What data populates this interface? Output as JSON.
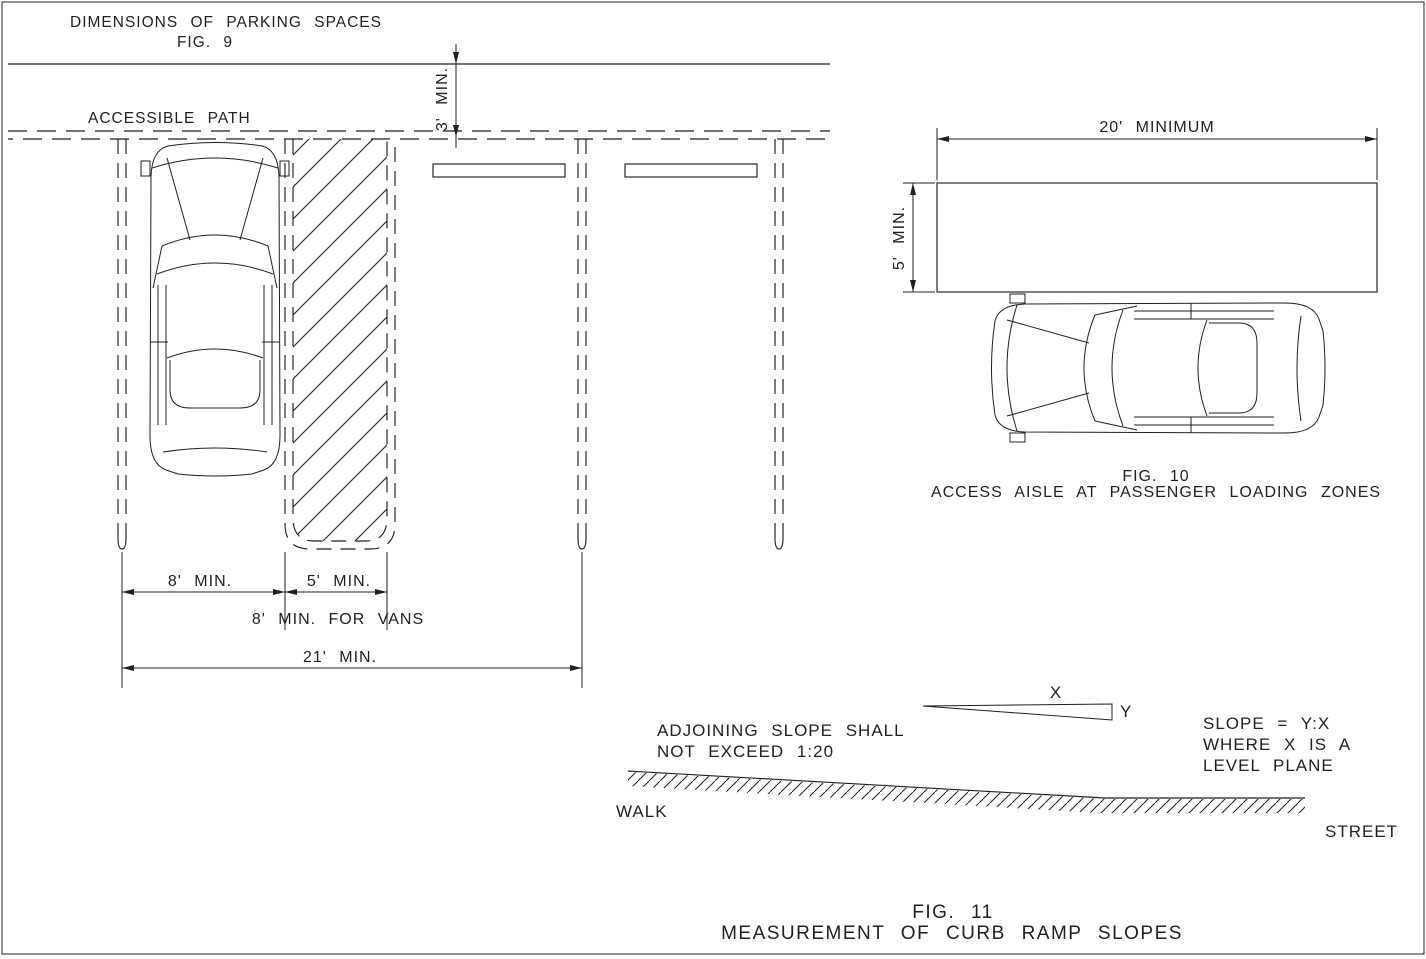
{
  "page": {
    "background": "#ffffff",
    "line_color": "#1f1f1f"
  },
  "fig9": {
    "title": "DIMENSIONS OF PARKING SPACES",
    "fig_label": "FIG. 9",
    "accessible_path_label": "ACCESSIBLE PATH",
    "dims": {
      "path_clearance": "3' MIN.",
      "parking_space": "8' MIN.",
      "access_aisle": "5' MIN.",
      "van_note": "8' MIN. FOR VANS",
      "total": "21' MIN."
    }
  },
  "fig10": {
    "dims": {
      "length": "20' MINIMUM",
      "width": "5' MIN."
    },
    "fig_label": "FIG. 10",
    "caption": "ACCESS AISLE AT PASSENGER LOADING ZONES"
  },
  "fig11": {
    "x_label": "X",
    "y_label": "Y",
    "note_line1": "ADJOINING SLOPE SHALL",
    "note_line2": "NOT EXCEED 1:20",
    "slope_line1": "SLOPE = Y:X",
    "slope_line2": "WHERE X IS A",
    "slope_line3": "LEVEL PLANE",
    "walk_label": "WALK",
    "street_label": "STREET",
    "fig_label": "FIG. 11",
    "caption": "MEASUREMENT OF CURB RAMP SLOPES"
  }
}
